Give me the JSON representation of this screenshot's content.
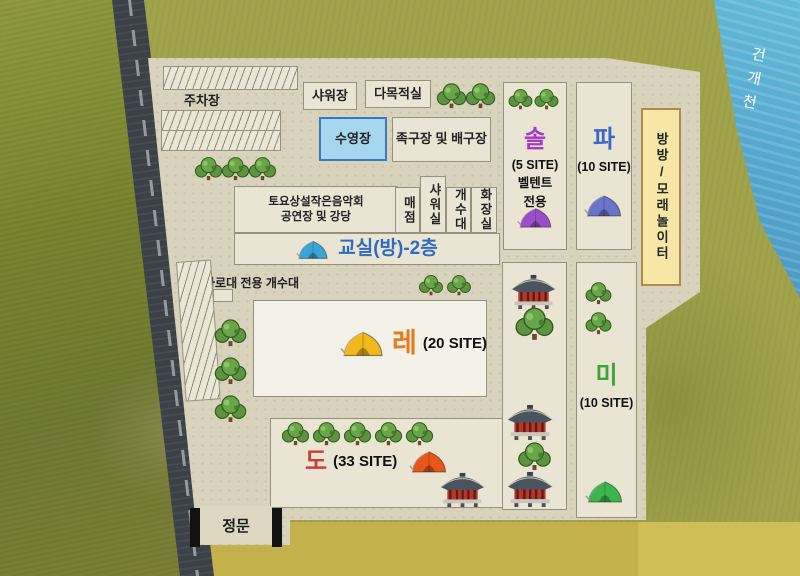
{
  "map": {
    "river_label": "건개천",
    "gate_label": "정문",
    "parking_label": "주차장",
    "firepit_sink_label": "화로대 전용 개수대"
  },
  "facilities": {
    "shower_house": "샤워장",
    "multipurpose_room": "다목적실",
    "swimming_pool": "수영장",
    "sports_court": "족구장 및 배구장",
    "concert_line1": "토요상설작은음악회",
    "concert_line2": "공연장 및 강당",
    "store": "매점",
    "shower_room": "샤워실",
    "sink": "개수대",
    "restroom": "화장실",
    "classroom": "교실(방)-2층",
    "trampoline_sand": "방방/모래놀이터"
  },
  "sites": {
    "sol": {
      "name": "솔",
      "count": "(5 SITE)",
      "note_line1": "벨텐트",
      "note_line2": "전용",
      "name_color": "#a638c6",
      "tent_color": "#9b4ec9"
    },
    "pa": {
      "name": "파",
      "count": "(10 SITE)",
      "name_color": "#3a67c9",
      "tent_color": "#6a74ca"
    },
    "re": {
      "name": "레",
      "count": "(20 SITE)",
      "name_color": "#e8791e",
      "tent_color": "#f2b91c"
    },
    "mi": {
      "name": "미",
      "count": "(10 SITE)",
      "name_color": "#3aa33a",
      "tent_color": "#3cb54e"
    },
    "do": {
      "name": "도",
      "count": "(33 SITE)",
      "name_color": "#cc3b3b",
      "tent_color": "#e8561a"
    }
  },
  "colors": {
    "classroom_text": "#2e6bc0",
    "classroom_tent": "#3aa4d6",
    "pool_fill": "#a6d7ef",
    "pool_border": "#3a7bbf",
    "trampoline_fill": "#f6e7a6",
    "trampoline_border": "#b08a4a",
    "river": "#4a9cc6",
    "road": "#3b4147",
    "campground": "#d9d2bc"
  }
}
